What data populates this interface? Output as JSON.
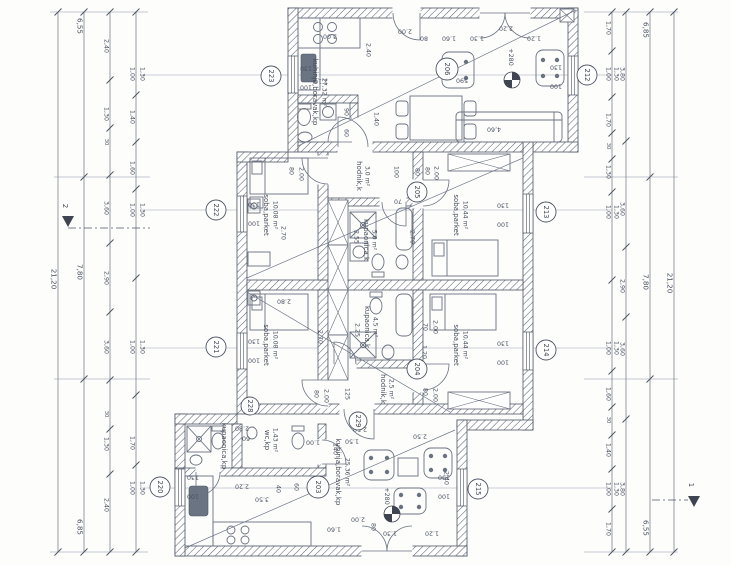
{
  "drawing": {
    "type": "floor plan",
    "rooms": [
      {
        "name": "kuhinja,boravak,kp",
        "area": "27,32 m²"
      },
      {
        "name": "hodnik,k",
        "area": "3,0 m²"
      },
      {
        "name": "soba,parket",
        "area": "10,08 m²"
      },
      {
        "name": "soba,parket",
        "area": "10,44 m²"
      },
      {
        "name": "kupaonica,k",
        "area": "5,0 m²"
      },
      {
        "name": "soba,parket",
        "area": "10,08 m²"
      },
      {
        "name": "kupaonica,k",
        "area": "4,5 m²"
      },
      {
        "name": "hodnik,k",
        "area": "2,5 m²"
      },
      {
        "name": "soba,parket",
        "area": "10,44 m²"
      },
      {
        "name": "kupaonica,kp",
        "area": ""
      },
      {
        "name": "wc,kp",
        "area": "1,43 m²"
      },
      {
        "name": "kuhinja,boravak,kp",
        "area": "25,36 m²"
      }
    ],
    "markers": {
      "window": [
        "223",
        "222",
        "221",
        "220",
        "212",
        "213",
        "214",
        "215"
      ],
      "door": [
        "228",
        "229"
      ],
      "room": [
        "206",
        "205",
        "204",
        "203"
      ]
    },
    "levels": [
      "+280",
      "+280"
    ],
    "sections": [
      "2",
      "1"
    ]
  },
  "dims": {
    "window": [
      "130",
      "100"
    ],
    "left": {
      "total": "21,20",
      "majors": [
        "6,55",
        "7,80",
        "6,85"
      ],
      "mid": [
        "2,40",
        "1,30",
        "30",
        "3,60",
        "2,90",
        "3,60",
        "30",
        "1,30",
        "2,40"
      ],
      "fine": [
        "1,00",
        "1,30",
        "1,40",
        "1,60",
        "1,00",
        "1,30",
        "1,00",
        "1,30",
        "1,70",
        "1,00",
        "1,30"
      ]
    },
    "right": {
      "total": "21,20",
      "majors": [
        "6,85",
        "7,80",
        "6,55"
      ],
      "mid": [
        "3,80",
        "3,60",
        "2,90",
        "3,60",
        "3,80"
      ],
      "fine": [
        "1,70",
        "1,00",
        "1,30",
        "1,70",
        "30",
        "1,30",
        "1,00",
        "1,30",
        "1,00",
        "1,30",
        "1,60",
        "30",
        "1,40",
        "1,00",
        "1,30",
        "1,70"
      ]
    },
    "interior": [
      "3.00",
      "2.40",
      "2.10",
      "2.00",
      "80",
      "1.60",
      "1.30",
      "2.20",
      "1.20",
      "590",
      "4,60",
      "1,40",
      "90",
      "60",
      "80",
      "2.00",
      "2.70",
      "100",
      "80",
      "70",
      "2.55",
      "2.70",
      "80",
      "2.00",
      "2.80",
      "2.70",
      "2.25",
      "80",
      "2.00",
      "125",
      "70",
      "2.00",
      "1.20",
      "80",
      "2.00",
      "2.80",
      "60",
      "2.50",
      "2.50",
      "1.50",
      "1.00",
      "140",
      "2.20",
      "3.50",
      "40",
      "60",
      "2.00",
      "80",
      "1.60",
      "1.30",
      "1.20",
      "2.40"
    ]
  }
}
